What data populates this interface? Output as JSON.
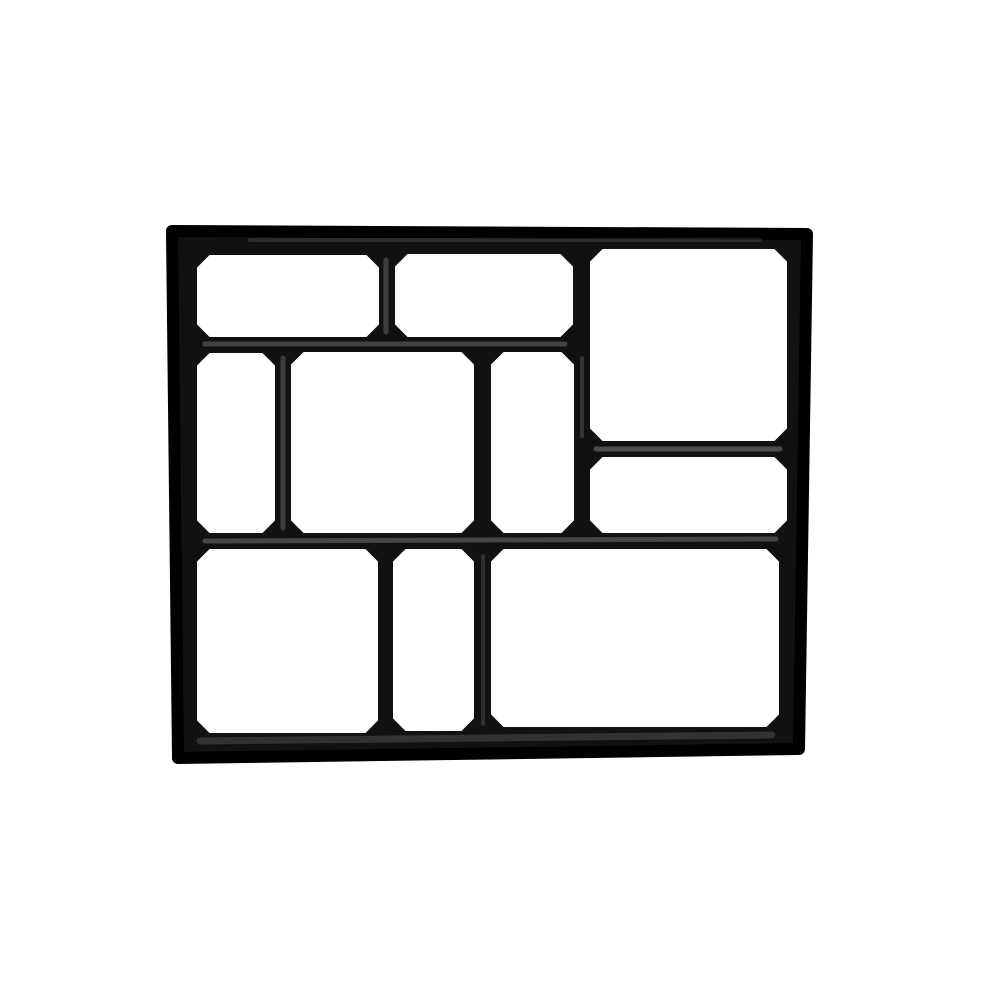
{
  "product_image": {
    "description": "Top view of a black plastic DIY path maker paving mould with ten irregular rectangular cells on a plain white background",
    "background_color": "#ffffff",
    "wall_color": "#111111",
    "wall_edge_color": "#000000",
    "sheen_color": "#8a8a8a",
    "canvas": {
      "width": 1002,
      "height": 1002
    },
    "outer_outline": [
      [
        172,
        231
      ],
      [
        807,
        234
      ],
      [
        799,
        749
      ],
      [
        178,
        758
      ]
    ],
    "outer_corner_stroke": 12,
    "cell_chamfer": 12,
    "cells": [
      {
        "name": "top-left-rect",
        "x": 198,
        "y": 256,
        "w": 180,
        "h": 80
      },
      {
        "name": "top-middle-rect",
        "x": 396,
        "y": 255,
        "w": 176,
        "h": 81
      },
      {
        "name": "top-right-large",
        "x": 591,
        "y": 250,
        "w": 195,
        "h": 190
      },
      {
        "name": "mid-left-narrow",
        "x": 198,
        "y": 354,
        "w": 76,
        "h": 178
      },
      {
        "name": "mid-center-square",
        "x": 292,
        "y": 353,
        "w": 181,
        "h": 179
      },
      {
        "name": "mid-right-narrow",
        "x": 492,
        "y": 353,
        "w": 81,
        "h": 179
      },
      {
        "name": "right-wide-short",
        "x": 591,
        "y": 458,
        "w": 195,
        "h": 74
      },
      {
        "name": "bottom-left-large",
        "x": 198,
        "y": 550,
        "w": 179,
        "h": 182
      },
      {
        "name": "bottom-middle-narrow",
        "x": 394,
        "y": 550,
        "w": 79,
        "h": 180
      },
      {
        "name": "bottom-right-large",
        "x": 492,
        "y": 550,
        "w": 286,
        "h": 176
      }
    ],
    "sheen_stripes": [
      {
        "x1": 205,
        "y1": 344,
        "x2": 565,
        "y2": 344,
        "w": 5,
        "o": 0.42
      },
      {
        "x1": 596,
        "y1": 449,
        "x2": 780,
        "y2": 449,
        "w": 5,
        "o": 0.5
      },
      {
        "x1": 205,
        "y1": 541,
        "x2": 776,
        "y2": 539,
        "w": 5,
        "o": 0.45
      },
      {
        "x1": 200,
        "y1": 741,
        "x2": 772,
        "y2": 735,
        "w": 7,
        "o": 0.28
      },
      {
        "x1": 386,
        "y1": 260,
        "x2": 386,
        "y2": 332,
        "w": 5,
        "o": 0.38
      },
      {
        "x1": 283,
        "y1": 358,
        "x2": 283,
        "y2": 528,
        "w": 5,
        "o": 0.35
      },
      {
        "x1": 582,
        "y1": 358,
        "x2": 582,
        "y2": 436,
        "w": 4,
        "o": 0.3
      },
      {
        "x1": 483,
        "y1": 556,
        "x2": 483,
        "y2": 724,
        "w": 4,
        "o": 0.25
      },
      {
        "x1": 250,
        "y1": 240,
        "x2": 760,
        "y2": 240,
        "w": 4,
        "o": 0.22
      }
    ]
  }
}
